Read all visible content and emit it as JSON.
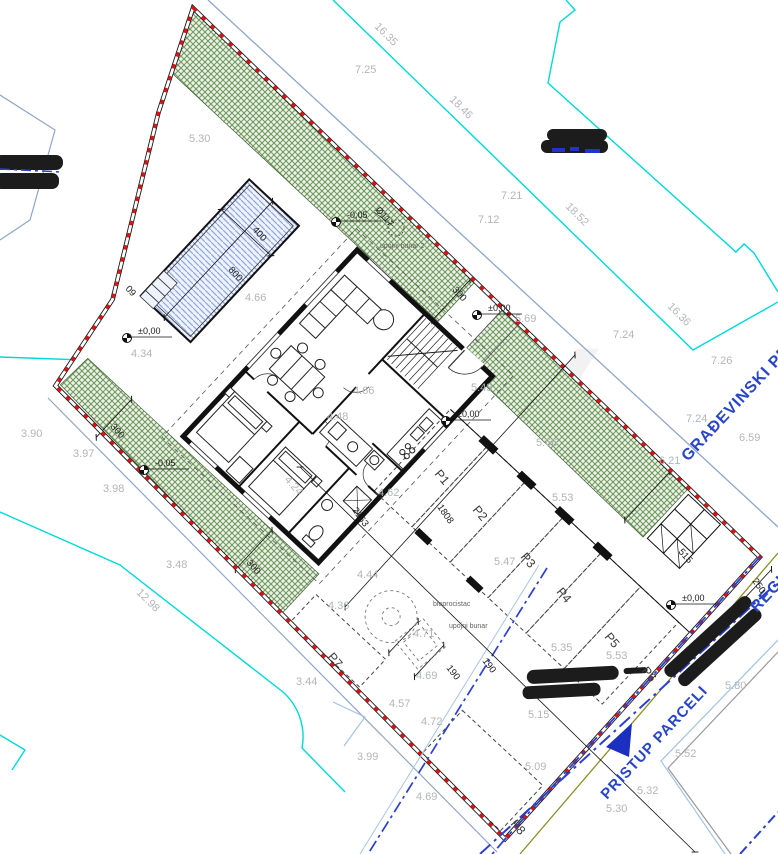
{
  "texts": {
    "building_line": "GRAĐEVINSKI PRAVAC",
    "regulation_line": "REGULACIJSKI PRAVAC",
    "access": "PRISTUP PARCELI",
    "watermark1": "DUX",
    "watermark2": "REAL ESTATE"
  },
  "colors": {
    "boundary_red": "#e01010",
    "parcel_cyan": "#00d9d9",
    "road_blue": "#2b3fd0",
    "steel_blue": "#8fa6c8",
    "olive": "#8a8f28",
    "green_fill": "#eef2e8",
    "green_hatch": "#6f9a5f",
    "pool_fill": "#eef2fb",
    "pool_hatch": "#8fa8e0",
    "label_gray": "#b2b5b9",
    "blue_text": "#2946c8"
  },
  "parcel_numbers": [
    {
      "t": "16.35",
      "x": 374,
      "y": 27,
      "r": 45
    },
    {
      "t": "7.25",
      "x": 355,
      "y": 73,
      "r": 0
    },
    {
      "t": "18.46",
      "x": 449,
      "y": 100,
      "r": 45
    },
    {
      "t": "5.30",
      "x": 189,
      "y": 142,
      "r": 0
    },
    {
      "t": "7.21",
      "x": 501,
      "y": 199,
      "r": 0
    },
    {
      "t": "7.12",
      "x": 478,
      "y": 223,
      "r": 0
    },
    {
      "t": "18.52",
      "x": 565,
      "y": 207,
      "r": 45
    },
    {
      "t": "16.36",
      "x": 667,
      "y": 307,
      "r": 45
    },
    {
      "t": "7.24",
      "x": 613,
      "y": 338,
      "r": 0
    },
    {
      "t": "7.26",
      "x": 711,
      "y": 364,
      "r": 0
    },
    {
      "t": "7.24",
      "x": 686,
      "y": 422,
      "r": 0
    },
    {
      "t": "6.59",
      "x": 739,
      "y": 441,
      "r": 0
    },
    {
      "t": "6.21",
      "x": 659,
      "y": 464,
      "r": 0
    },
    {
      "t": "3.90",
      "x": 21,
      "y": 437,
      "r": 0
    },
    {
      "t": "3.97",
      "x": 73,
      "y": 457,
      "r": 0
    },
    {
      "t": "3.98",
      "x": 103,
      "y": 492,
      "r": 0
    },
    {
      "t": "3.48",
      "x": 166,
      "y": 568,
      "r": 0
    },
    {
      "t": "12.98",
      "x": 136,
      "y": 593,
      "r": 45
    },
    {
      "t": "3.44",
      "x": 296,
      "y": 685,
      "r": 0
    },
    {
      "t": "3.99",
      "x": 357,
      "y": 760,
      "r": 0
    },
    {
      "t": "4.69",
      "x": 416,
      "y": 800,
      "r": 0
    },
    {
      "t": "4.57",
      "x": 389,
      "y": 707,
      "r": 0
    },
    {
      "t": "4.72",
      "x": 421,
      "y": 725,
      "r": 0
    },
    {
      "t": "4.69",
      "x": 416,
      "y": 679,
      "r": 0
    },
    {
      "t": "4.71",
      "x": 413,
      "y": 637,
      "r": 0
    },
    {
      "t": "4.36",
      "x": 328,
      "y": 609,
      "r": 0
    },
    {
      "t": "4.44",
      "x": 357,
      "y": 578,
      "r": 0
    },
    {
      "t": "4.62",
      "x": 378,
      "y": 496,
      "r": 0
    },
    {
      "t": "4.66",
      "x": 245,
      "y": 301,
      "r": 0
    },
    {
      "t": "4.66",
      "x": 353,
      "y": 394,
      "r": 0
    },
    {
      "t": "4.48",
      "x": 327,
      "y": 420,
      "r": 0
    },
    {
      "t": "4.24",
      "x": 284,
      "y": 480,
      "r": 48
    },
    {
      "t": "4.34",
      "x": 131,
      "y": 357,
      "r": 0
    },
    {
      "t": "5.69",
      "x": 515,
      "y": 322,
      "r": 0
    },
    {
      "t": "5.43",
      "x": 471,
      "y": 391,
      "r": 0
    },
    {
      "t": "5.66",
      "x": 536,
      "y": 446,
      "r": 0
    },
    {
      "t": "5.53",
      "x": 552,
      "y": 501,
      "r": 0
    },
    {
      "t": "5.47",
      "x": 494,
      "y": 565,
      "r": 0
    },
    {
      "t": "5.35",
      "x": 551,
      "y": 651,
      "r": 0
    },
    {
      "t": "5.53",
      "x": 606,
      "y": 659,
      "r": 0
    },
    {
      "t": "5.15",
      "x": 528,
      "y": 718,
      "r": 0
    },
    {
      "t": "5.09",
      "x": 525,
      "y": 770,
      "r": 0
    },
    {
      "t": "5.32",
      "x": 637,
      "y": 794,
      "r": 0
    },
    {
      "t": "5.30",
      "x": 606,
      "y": 812,
      "r": 0
    },
    {
      "t": "5.52",
      "x": 675,
      "y": 757,
      "r": 0
    },
    {
      "t": "5.80",
      "x": 725,
      "y": 689,
      "r": 0
    }
  ],
  "dimensions": [
    {
      "t": "400",
      "x": 252,
      "y": 230,
      "r": 48
    },
    {
      "t": "800",
      "x": 228,
      "y": 270,
      "r": 48
    },
    {
      "t": "300",
      "x": 452,
      "y": 290,
      "r": 48
    },
    {
      "t": "300",
      "x": 110,
      "y": 427,
      "r": 48
    },
    {
      "t": "300",
      "x": 246,
      "y": 563,
      "r": 48
    },
    {
      "t": "515",
      "x": 678,
      "y": 552,
      "r": 48
    },
    {
      "t": "250",
      "x": 752,
      "y": 581,
      "r": 55
    },
    {
      "t": "190",
      "x": 446,
      "y": 668,
      "r": 52
    },
    {
      "t": "190",
      "x": 482,
      "y": 661,
      "r": 52
    },
    {
      "t": "2163",
      "x": 352,
      "y": 510,
      "r": 55
    },
    {
      "t": "1808",
      "x": 437,
      "y": 507,
      "r": 55
    },
    {
      "t": "Ø117",
      "x": 375,
      "y": 210,
      "r": 50
    },
    {
      "t": "09",
      "x": 125,
      "y": 289,
      "r": 48
    }
  ],
  "benchmarks": [
    {
      "t": "±0,00",
      "x": 127,
      "y": 338
    },
    {
      "t": "±0,00",
      "x": 446,
      "y": 421
    },
    {
      "t": "±0,00",
      "x": 477,
      "y": 315
    },
    {
      "t": "±0,00",
      "x": 671,
      "y": 605
    },
    {
      "t": "-0,05",
      "x": 144,
      "y": 470
    },
    {
      "t": "-0,05",
      "x": 336,
      "y": 222
    }
  ],
  "parking_spaces": [
    {
      "t": "P1",
      "x": 434,
      "y": 474,
      "r": 50
    },
    {
      "t": "P2",
      "x": 472,
      "y": 510,
      "r": 50
    },
    {
      "t": "P3",
      "x": 520,
      "y": 557,
      "r": 50
    },
    {
      "t": "P4",
      "x": 556,
      "y": 592,
      "r": 50
    },
    {
      "t": "P5",
      "x": 604,
      "y": 637,
      "r": 50
    },
    {
      "t": "P6",
      "x": 641,
      "y": 671,
      "r": 50
    },
    {
      "t": "P7",
      "x": 327,
      "y": 657,
      "r": 50
    },
    {
      "t": "P8",
      "x": 510,
      "y": 824,
      "r": 50
    }
  ],
  "utilities": [
    {
      "t": "bioprocistac",
      "x": 433,
      "y": 606
    },
    {
      "t": "upojni bunar",
      "x": 449,
      "y": 628
    },
    {
      "t": "upojni bunar 2",
      "x": 380,
      "y": 248
    }
  ]
}
